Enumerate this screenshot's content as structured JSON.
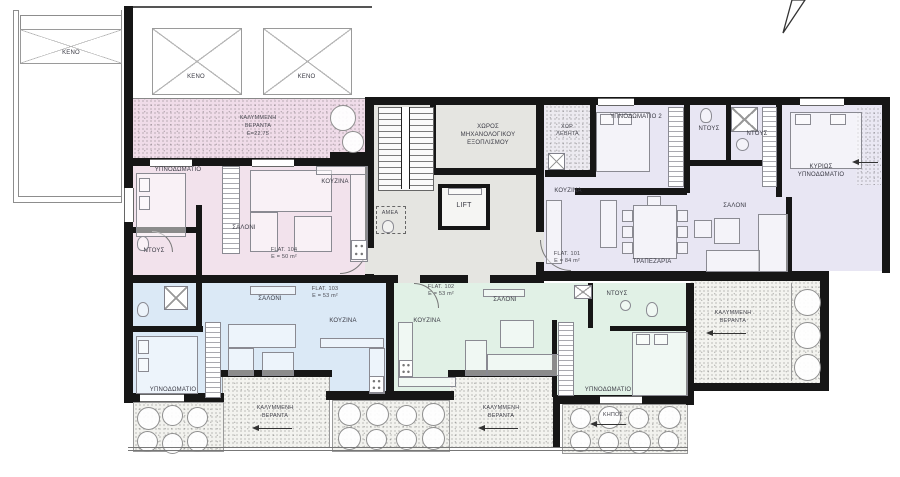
{
  "labels": {
    "keno": "ΚΕΝΟ",
    "covered_veranda_line1": "ΚΑΛΥΜΜΕΝΗ",
    "covered_veranda_line2": "ΒΕΡΑΝΤΑ",
    "top_veranda_area": "Ε=22.75",
    "garden": "ΚΗΠΟΣ",
    "lift": "LIFT",
    "amea": "ΑΜΕΑ",
    "mech_room_line1": "ΧΩΡΟΣ",
    "mech_room_line2": "ΜΗΧΑΝΟΛΟΓΙΚΟΥ",
    "mech_room_line3": "ΕΞΟΠΛΙΣΜΟΥ",
    "boiler_line1": "ΧΩΡ.",
    "boiler_line2": "ΛΕΒΗΤΑ",
    "bedroom": "ΥΠΝΟΔΩΜΑΤΙΟ",
    "bedroom2": "ΥΠΝΟΔΩΜΑΤΙΟ 2",
    "master_line1": "ΚΥΡΙΩΣ",
    "master_line2": "ΥΠΝΟΔΩΜΑΤΙΟ",
    "kitchen": "ΚΟΥΖΙΝΑ",
    "living": "ΣΑΛΟΝΙ",
    "dining": "ΤΡΑΠΕΖΑΡΙΑ",
    "shower": "ΝΤΟΥΣ"
  },
  "flats": {
    "f101": {
      "name": "FLAT. 101",
      "area": "E = 84 m²"
    },
    "f102": {
      "name": "FLAT. 102",
      "area": "E = 53 m²"
    },
    "f103": {
      "name": "FLAT. 103",
      "area": "E = 53 m²"
    },
    "f104": {
      "name": "FLAT. 104",
      "area": "E = 50 m²"
    }
  },
  "icons": {
    "north_arrow": "north-arrow",
    "level_arrow": "level-arrow",
    "void_cross": "x-cross"
  },
  "colors": {
    "flat101_floor": "#e8e6f3",
    "flat102_floor": "#e1f1e6",
    "flat103_floor": "#dbe9f6",
    "flat104_floor": "#f2e2ec",
    "veranda_pink": "#f0dce9",
    "core_floor": "#e5e5e1",
    "veranda_grey": "#f3f3ef",
    "wall": "#161616"
  }
}
